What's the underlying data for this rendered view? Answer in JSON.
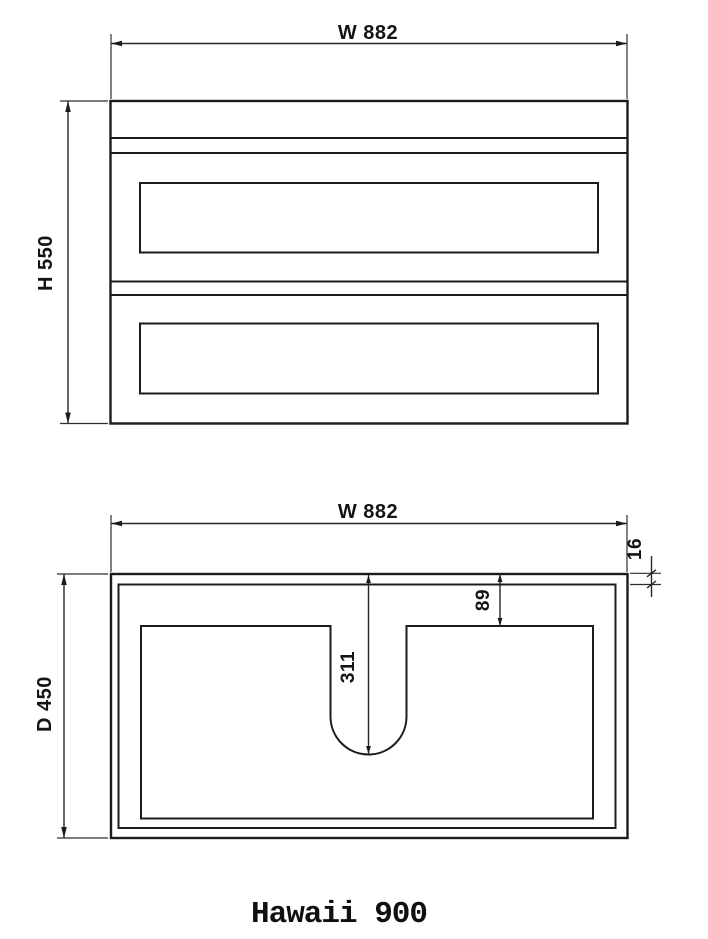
{
  "drawing": {
    "caption": "Hawaii 900",
    "line_color": "#1b1b1b",
    "background_color": "#ffffff",
    "front_view": {
      "name": "front-elevation",
      "width_label": "W 882",
      "height_label": "H 550"
    },
    "plan_view": {
      "name": "top-plan",
      "width_label": "W 882",
      "depth_label": "D 450",
      "top_thickness_label": "16",
      "basin_back_offset_label": "89",
      "basin_cutout_depth_label": "311"
    }
  }
}
